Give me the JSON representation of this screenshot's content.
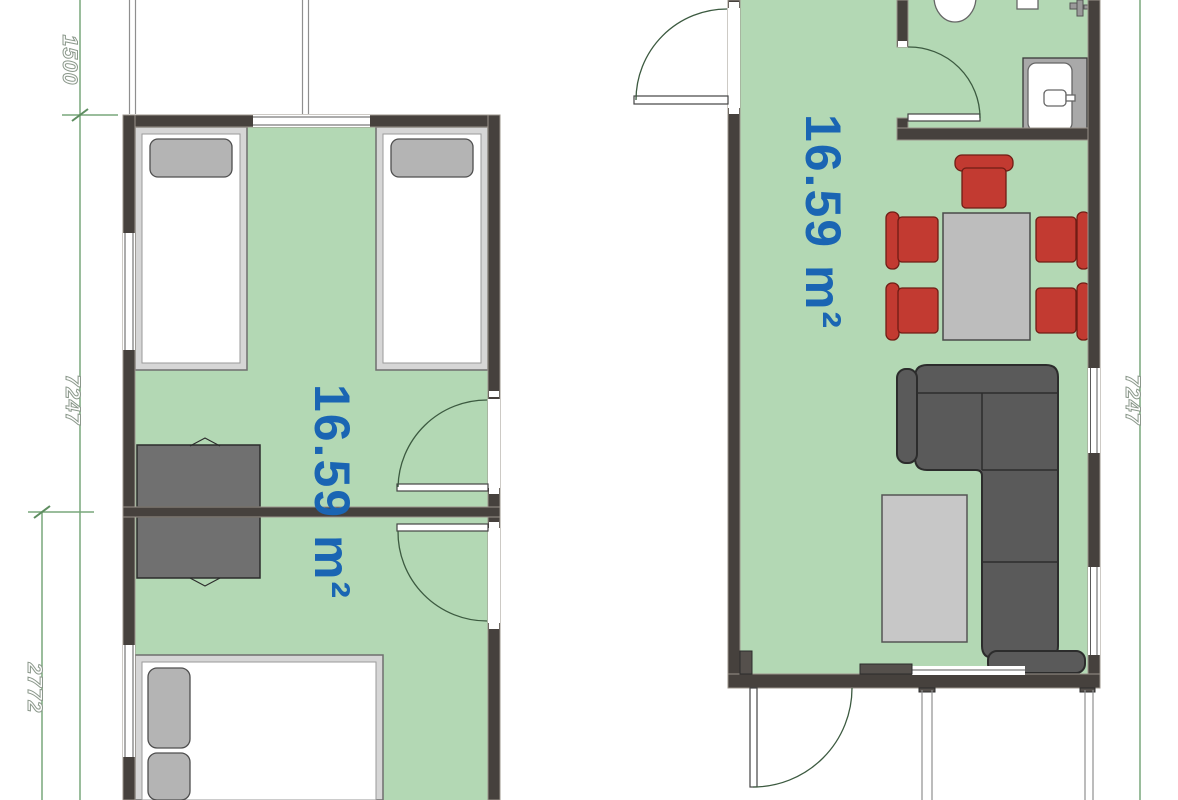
{
  "drawing_type": "floor-plan",
  "units": {
    "left": {
      "area": "16.59 m²",
      "furniture": [
        "single-bed",
        "single-bed",
        "wardrobe",
        "wardrobe",
        "double-bed"
      ]
    },
    "right": {
      "area": "16.59 m²",
      "furniture": [
        "toilet",
        "sink",
        "dining-table",
        "dining-chair",
        "dining-chair",
        "dining-chair",
        "dining-chair",
        "dining-chair",
        "corner-sofa",
        "coffee-table"
      ]
    }
  },
  "dimensions_mm": {
    "top_left": "1500",
    "left_height": "7247",
    "bottom_left": "2772",
    "right_height": "7247"
  },
  "colors": {
    "floor": "#b3d8b4",
    "wall": "#46413d",
    "area_text": "#1a65b3",
    "chair_red": "#c23a31",
    "sofa_gray": "#5a5a5a",
    "dimension_green": "#79a77b"
  }
}
